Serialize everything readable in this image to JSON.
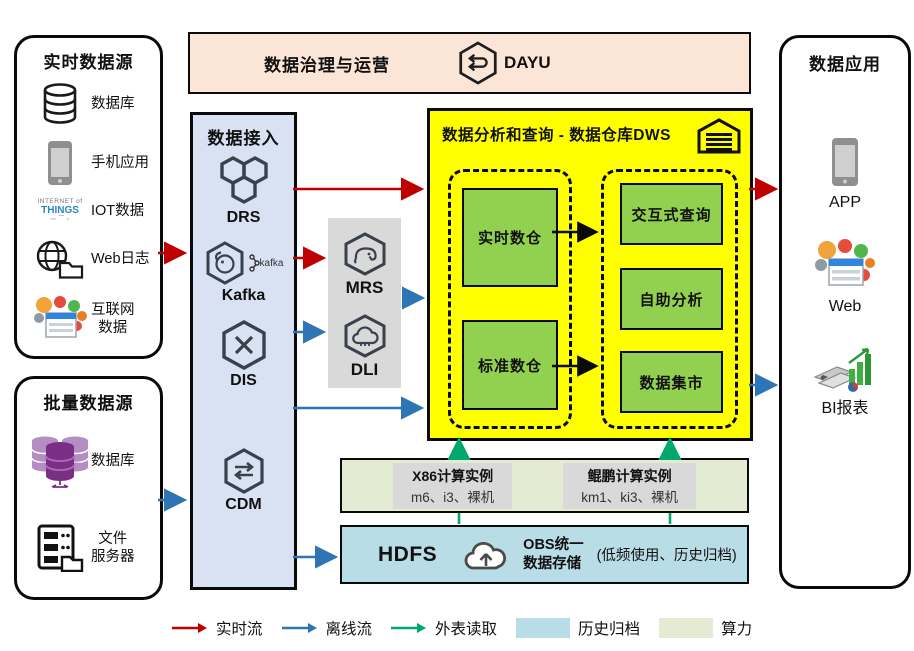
{
  "colors": {
    "realtime_flow": "#BE0000",
    "offline_flow": "#2E75B6",
    "external_read": "#00A86B",
    "archive_fill": "#B9DDE6",
    "compute_fill": "#E3EBD3",
    "dws_fill": "#FFFF00",
    "module_green": "#92D050",
    "governance_fill": "#FBE5D6",
    "access_fill": "#D9E2F3"
  },
  "governance": {
    "title": "数据治理与运营",
    "product": "DAYU"
  },
  "sources_realtime": {
    "title": "实时数据源",
    "items": [
      {
        "icon": "database-icon",
        "lines": [
          "数据库",
          ""
        ]
      },
      {
        "icon": "mobile-icon",
        "lines": [
          "手机应用",
          ""
        ]
      },
      {
        "icon": "iot-icon",
        "lines": [
          "IOT数据",
          ""
        ]
      },
      {
        "icon": "weblog-icon",
        "lines": [
          "Web日志",
          ""
        ]
      },
      {
        "icon": "internet-icon",
        "lines": [
          "互联网",
          "数据"
        ]
      }
    ]
  },
  "sources_batch": {
    "title": "批量数据源",
    "items": [
      {
        "icon": "database-purple-icon",
        "lines": [
          "数据库",
          ""
        ]
      },
      {
        "icon": "file-server-icon",
        "lines": [
          "文件",
          "服务器"
        ]
      }
    ]
  },
  "iot_text": {
    "line1": "INTERNET of",
    "line2": "THINGS"
  },
  "data_access": {
    "title": "数据接入",
    "items": [
      "DRS",
      "Kafka",
      "DIS",
      "CDM"
    ],
    "kafka_logo": "kafka"
  },
  "processing": {
    "items": [
      "MRS",
      "DLI"
    ]
  },
  "dws": {
    "title": "数据分析和查询 - 数据仓库DWS",
    "warehouses": [
      "实时数仓",
      "标准数仓"
    ],
    "services": [
      "交互式查询",
      "自助分析",
      "数据集市"
    ]
  },
  "compute": {
    "x86_title": "X86计算实例",
    "x86_detail": "m6、i3、裸机",
    "kunpeng_title": "鲲鹏计算实例",
    "kunpeng_detail": "km1、ki3、裸机"
  },
  "storage": {
    "hdfs": "HDFS",
    "obs_line1": "OBS统一",
    "obs_line2": "数据存储",
    "note": "(低频使用、历史归档)"
  },
  "apps": {
    "title": "数据应用",
    "items": [
      {
        "icon": "app-icon",
        "label": "APP"
      },
      {
        "icon": "web-icon",
        "label": "Web"
      },
      {
        "icon": "bi-icon",
        "label": "BI报表"
      }
    ]
  },
  "legend": {
    "realtime": "实时流",
    "offline": "离线流",
    "external": "外表读取",
    "archive": "历史归档",
    "compute": "算力"
  }
}
